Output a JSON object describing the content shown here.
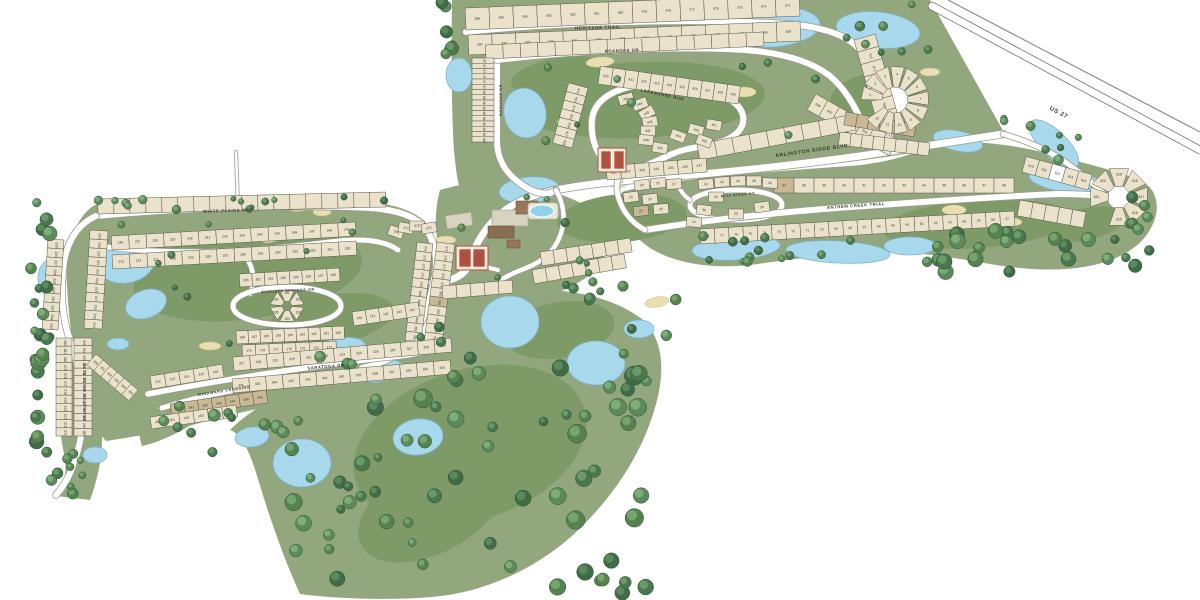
{
  "colors": {
    "land": "#93A77E",
    "fairway": "#7E9B67",
    "fairway_light": "#9DB284",
    "pond": "#A8D8EC",
    "pond_edge": "#7EB4D0",
    "lot": "#EBE2CC",
    "tan": "#C8B893",
    "white": "#FFFFFF",
    "lot_edge": "#56564A",
    "lot_text": "#33332B",
    "road": "#FFFFFF",
    "road_edge": "#9B9B90",
    "highway_edge": "#6F6F68",
    "label": "#3A3A30",
    "sand": "#E8DEB0",
    "sand_edge": "#CDBF8E"
  },
  "streets": [
    {
      "name": "HERITAGE TRAIL",
      "x": 598,
      "y": 29,
      "a": -2,
      "s": 4.5
    },
    {
      "name": "ROANOKE DR",
      "x": 622,
      "y": 52,
      "a": -2,
      "s": 4.2
    },
    {
      "name": "ROANOKE DR",
      "x": 502,
      "y": 100,
      "a": -90,
      "s": 3.8
    },
    {
      "name": "LAKESHORE RUN",
      "x": 662,
      "y": 96,
      "a": 12,
      "s": 4.2
    },
    {
      "name": "ARLINGTON RIDGE BLVD",
      "x": 812,
      "y": 152,
      "a": -8,
      "s": 5
    },
    {
      "name": "US 27",
      "x": 1058,
      "y": 114,
      "a": 28,
      "s": 6
    },
    {
      "name": "ANTHEM CREEK TRIAL",
      "x": 856,
      "y": 207,
      "a": -4,
      "s": 4.2
    },
    {
      "name": "RIVA RIDGE CT",
      "x": 738,
      "y": 196,
      "a": -5,
      "s": 3.6
    },
    {
      "name": "WHITE PLAINS WAY",
      "x": 228,
      "y": 212,
      "a": -2,
      "s": 4.2
    },
    {
      "name": "AUGUSTA SPRINGS DR",
      "x": 288,
      "y": 292,
      "a": -3,
      "s": 3.8
    },
    {
      "name": "SARATOGA DR",
      "x": 326,
      "y": 368,
      "a": -5,
      "s": 4.2
    },
    {
      "name": "WINDWARD CROSSING",
      "x": 224,
      "y": 392,
      "a": -9,
      "s": 3.8
    },
    {
      "name": "ARLINGTON RIDGE BLVD",
      "x": 86,
      "y": 392,
      "a": -90,
      "s": 3.8
    }
  ],
  "lot_strips": [
    {
      "line": [
        466,
        30,
        800,
        16
      ],
      "depth": 22,
      "side": 1,
      "count": 14,
      "start": 586,
      "step": -1
    },
    {
      "line": [
        468,
        35,
        800,
        21
      ],
      "depth": 20,
      "side": -1,
      "count": 14,
      "start": 587,
      "step": 1
    },
    {
      "line": [
        486,
        59,
        764,
        46
      ],
      "depth": 14,
      "side": 1,
      "count": 16,
      "start": null,
      "step": 0
    },
    {
      "line": [
        494,
        58,
        494,
        142
      ],
      "depth": 22,
      "side": -1,
      "count": 16,
      "start": 475,
      "step": -1
    },
    {
      "line": [
        854,
        40,
        878,
        126
      ],
      "depth": 22,
      "side": 1,
      "count": 7,
      "start": 573,
      "step": -1
    },
    {
      "line": [
        816,
        94,
        898,
        140
      ],
      "depth": 18,
      "side": -1,
      "count": 7,
      "start": 599,
      "step": 1
    },
    {
      "line": [
        700,
        160,
        856,
        130
      ],
      "depth": 16,
      "side": 1,
      "count": 9,
      "start": null,
      "step": 0
    },
    {
      "line": [
        1022,
        172,
        1088,
        190
      ],
      "depth": 16,
      "side": 1,
      "count": 5,
      "start": 610,
      "step": 1,
      "fills": {
        "2": "white"
      }
    },
    {
      "line": [
        1020,
        200,
        1086,
        212
      ],
      "depth": 16,
      "side": -1,
      "count": 5,
      "start": null,
      "step": 0
    },
    {
      "line": [
        846,
        112,
        916,
        124
      ],
      "depth": 13,
      "side": -1,
      "count": 6,
      "start": null,
      "step": 0,
      "fill_all": "tan"
    },
    {
      "line": [
        840,
        132,
        930,
        143
      ],
      "depth": 13,
      "side": -1,
      "count": 8,
      "start": null,
      "step": 0
    },
    {
      "line": [
        774,
        193,
        1014,
        193
      ],
      "depth": 15,
      "side": 1,
      "count": 12,
      "start": 37,
      "step": 1,
      "fills": {
        "0": "tan"
      }
    },
    {
      "line": [
        700,
        229,
        1014,
        211
      ],
      "depth": 15,
      "side": -1,
      "count": 22,
      "start": 78,
      "step": -1
    },
    {
      "line": [
        588,
        88,
        572,
        148
      ],
      "depth": 20,
      "side": -1,
      "count": 7,
      "start": 412,
      "step": 1
    },
    {
      "line": [
        598,
        84,
        738,
        104
      ],
      "depth": 18,
      "side": 1,
      "count": 11,
      "start": 419,
      "step": 1
    },
    {
      "line": [
        606,
        166,
        706,
        158
      ],
      "depth": 14,
      "side": -1,
      "count": 7,
      "start": 431,
      "step": 1
    },
    {
      "line": [
        540,
        252,
        630,
        238
      ],
      "depth": 14,
      "side": -1,
      "count": 7,
      "start": null,
      "step": 0
    },
    {
      "line": [
        532,
        270,
        624,
        254
      ],
      "depth": 14,
      "side": -1,
      "count": 7,
      "start": null,
      "step": 0
    },
    {
      "line": [
        98,
        214,
        386,
        207
      ],
      "depth": 15,
      "side": 1,
      "count": 18,
      "start": null,
      "step": 0
    },
    {
      "line": [
        90,
        230,
        84,
        328
      ],
      "depth": 18,
      "side": 1,
      "count": 11,
      "start": 224,
      "step": -1
    },
    {
      "line": [
        64,
        240,
        58,
        330
      ],
      "depth": 16,
      "side": -1,
      "count": 10,
      "start": 225,
      "step": 1
    },
    {
      "line": [
        72,
        338,
        72,
        436
      ],
      "depth": 16,
      "side": -1,
      "count": 12,
      "start": 282,
      "step": -1
    },
    {
      "line": [
        74,
        338,
        74,
        436
      ],
      "depth": 18,
      "side": 1,
      "count": 13,
      "start": 295,
      "step": -1
    },
    {
      "line": [
        112,
        250,
        356,
        236
      ],
      "depth": 14,
      "side": 1,
      "count": 14,
      "start": 236,
      "step": 1
    },
    {
      "line": [
        112,
        255,
        356,
        241
      ],
      "depth": 14,
      "side": -1,
      "count": 14,
      "start": 213,
      "step": -1
    },
    {
      "line": [
        240,
        287,
        340,
        281
      ],
      "depth": 13,
      "side": 1,
      "count": 8,
      "start": 203,
      "step": -1
    },
    {
      "line": [
        236,
        331,
        344,
        326
      ],
      "depth": 13,
      "side": -1,
      "count": 9,
      "start": 188,
      "step": -1
    },
    {
      "line": [
        242,
        345,
        336,
        341
      ],
      "depth": 12,
      "side": -1,
      "count": 7,
      "start": 179,
      "step": -1
    },
    {
      "line": [
        437,
        242,
        423,
        350
      ],
      "depth": 18,
      "side": 1,
      "count": 12,
      "start": 375,
      "step": 1,
      "fills": {
        "6": "tan"
      }
    },
    {
      "line": [
        433,
        244,
        421,
        342
      ],
      "depth": 16,
      "side": -1,
      "count": 11,
      "start": 374,
      "step": -1
    },
    {
      "line": [
        234,
        371,
        452,
        352
      ],
      "depth": 14,
      "side": 1,
      "count": 13,
      "start": 317,
      "step": 1
    },
    {
      "line": [
        232,
        379,
        450,
        360
      ],
      "depth": 14,
      "side": -1,
      "count": 13,
      "start": 346,
      "step": -1
    },
    {
      "line": [
        170,
        404,
        266,
        390
      ],
      "depth": 13,
      "side": -1,
      "count": 7,
      "start": 340,
      "step": 1,
      "fill_all": "tan"
    },
    {
      "line": [
        150,
        417,
        236,
        405
      ],
      "depth": 12,
      "side": -1,
      "count": 6,
      "start": 350,
      "step": 1
    },
    {
      "line": [
        152,
        389,
        224,
        377
      ],
      "depth": 13,
      "side": 1,
      "count": 5,
      "start": 312,
      "step": 1
    },
    {
      "line": [
        96,
        354,
        138,
        390
      ],
      "depth": 14,
      "side": -1,
      "count": 6,
      "start": 300,
      "step": 1
    },
    {
      "line": [
        352,
        312,
        418,
        302
      ],
      "depth": 14,
      "side": -1,
      "count": 5,
      "start": 160,
      "step": 1
    },
    {
      "line": [
        442,
        286,
        512,
        280
      ],
      "depth": 13,
      "side": -1,
      "count": 5,
      "start": null,
      "step": 0
    }
  ],
  "lot_singles": [
    {
      "x": 706,
      "y": 184,
      "a": -6,
      "n": "32"
    },
    {
      "x": 722,
      "y": 182,
      "a": -4,
      "n": "33"
    },
    {
      "x": 738,
      "y": 181,
      "a": -2,
      "n": "34"
    },
    {
      "x": 754,
      "y": 181,
      "a": 0,
      "n": "35"
    },
    {
      "x": 770,
      "y": 183,
      "a": 3,
      "n": "36"
    },
    {
      "x": 716,
      "y": 197,
      "a": 0,
      "n": "31"
    },
    {
      "x": 704,
      "y": 210,
      "a": 8,
      "n": "30"
    },
    {
      "x": 736,
      "y": 214,
      "a": 0,
      "n": "29"
    },
    {
      "x": 762,
      "y": 207,
      "a": -8,
      "n": "28"
    },
    {
      "x": 694,
      "y": 222,
      "a": 5,
      "n": "27"
    },
    {
      "x": 642,
      "y": 185,
      "a": -8,
      "n": "20"
    },
    {
      "x": 658,
      "y": 183,
      "a": -5,
      "n": "21"
    },
    {
      "x": 674,
      "y": 184,
      "a": -3,
      "n": "22"
    },
    {
      "x": 650,
      "y": 199,
      "a": -6,
      "n": "23"
    },
    {
      "x": 631,
      "y": 197,
      "a": -8,
      "n": "24"
    },
    {
      "x": 641,
      "y": 211,
      "a": -6,
      "n": "25",
      "fill": "tan"
    },
    {
      "x": 661,
      "y": 209,
      "a": -4,
      "n": "26"
    },
    {
      "x": 626,
      "y": 99,
      "a": -15,
      "n": "445"
    },
    {
      "x": 640,
      "y": 104,
      "a": -20,
      "n": "444"
    },
    {
      "x": 647,
      "y": 113,
      "a": -30,
      "n": "443"
    },
    {
      "x": 650,
      "y": 122,
      "a": -10,
      "n": "442"
    },
    {
      "x": 648,
      "y": 131,
      "a": 0,
      "n": "441"
    },
    {
      "x": 646,
      "y": 140,
      "a": 5,
      "n": "440"
    },
    {
      "x": 660,
      "y": 148,
      "a": 10,
      "n": "455"
    },
    {
      "x": 678,
      "y": 136,
      "a": 20,
      "n": "454"
    },
    {
      "x": 696,
      "y": 130,
      "a": 15,
      "n": "453"
    },
    {
      "x": 704,
      "y": 141,
      "a": 20,
      "n": "452"
    },
    {
      "x": 714,
      "y": 125,
      "a": 10,
      "n": "451"
    },
    {
      "x": 396,
      "y": 232,
      "a": 20,
      "n": "370"
    },
    {
      "x": 406,
      "y": 228,
      "a": 10,
      "n": "371"
    },
    {
      "x": 417,
      "y": 226,
      "a": 0,
      "n": "372"
    },
    {
      "x": 429,
      "y": 228,
      "a": -10,
      "n": "373"
    }
  ],
  "cul_de_sacs": [
    {
      "cx": 895,
      "cy": 100,
      "r0": 13,
      "r1": 34,
      "a0": 168,
      "da": -27.5,
      "count": 12,
      "start": 1,
      "step": 1
    },
    {
      "cx": 1119,
      "cy": 197,
      "r0": 11,
      "r1": 30,
      "a0": -90,
      "da": 45,
      "count": 7,
      "start": 615,
      "step": 1
    },
    {
      "cx": 287,
      "cy": 306,
      "r0": 5,
      "r1": 17,
      "a0": 150,
      "da": -60,
      "count": 6,
      "start": 190,
      "step": 1
    }
  ]
}
